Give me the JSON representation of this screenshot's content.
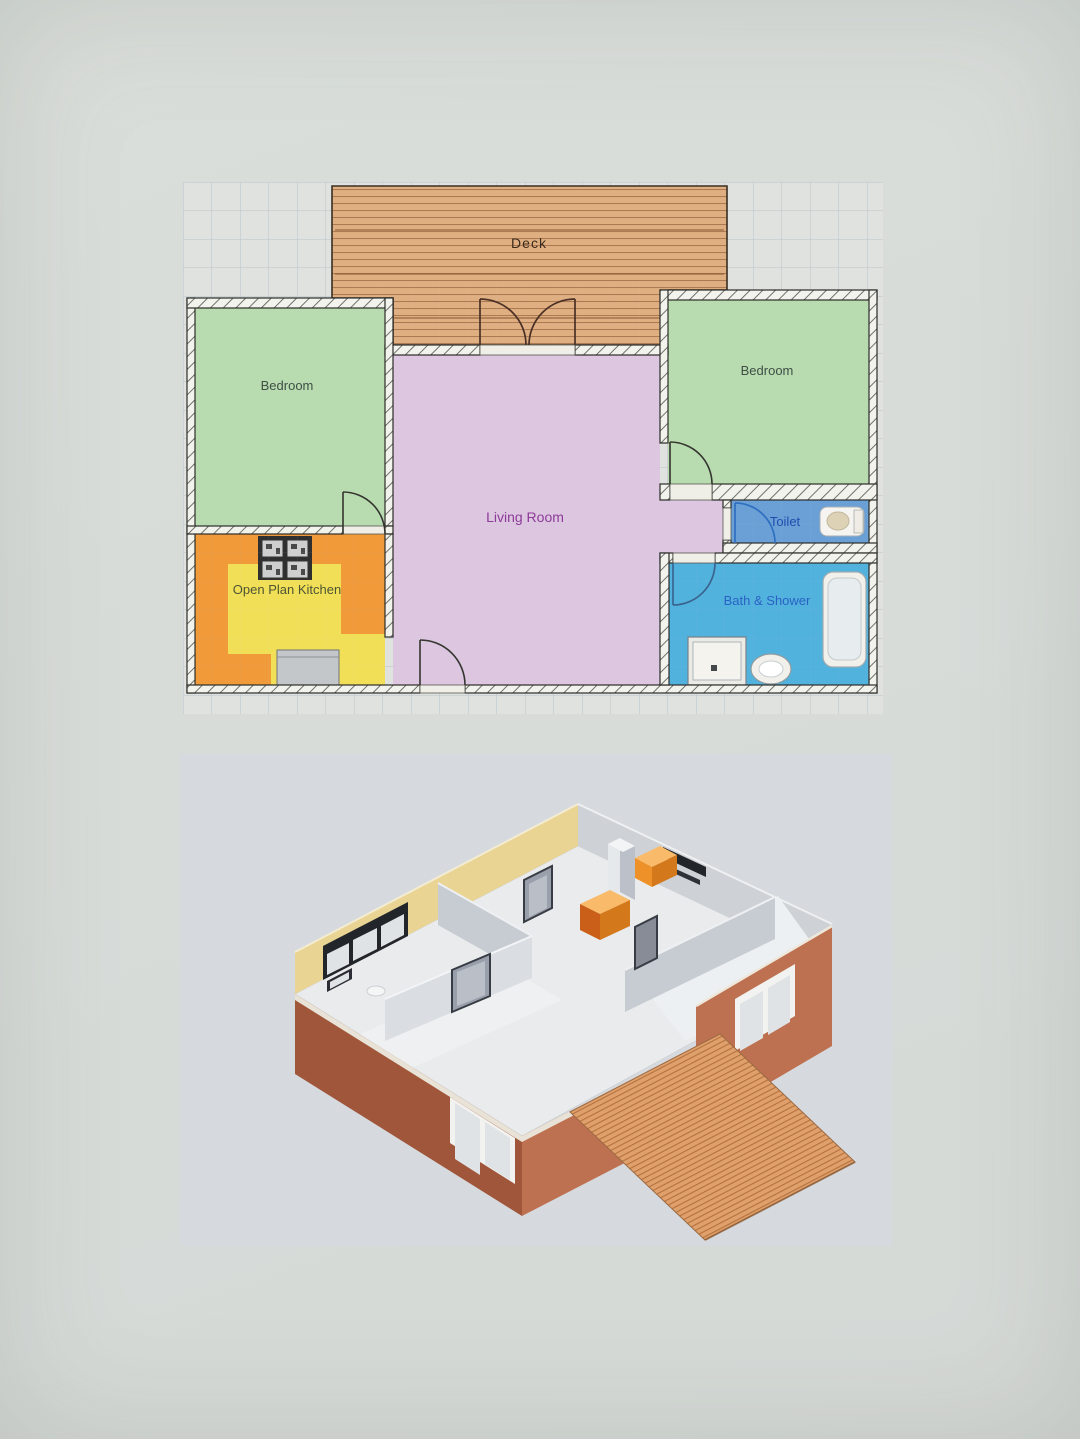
{
  "page": {
    "paper_color": "#d8dcd9"
  },
  "floor_plan": {
    "area_background": "#dfe2df",
    "grid_color": "#b4bfc4",
    "wall_fill": "#f3f3ee",
    "wall_outline": "#2c2c28",
    "rooms": {
      "deck": {
        "label": "Deck",
        "fill": "#e0af81",
        "stripe_color": "#a3714a",
        "label_color": "#3b2b1c"
      },
      "bedroom_left": {
        "label": "Bedroom",
        "fill": "#b8dcb0",
        "label_color": "#3f4f46"
      },
      "bedroom_right": {
        "label": "Bedroom",
        "fill": "#b8dcb0",
        "label_color": "#3f4f46"
      },
      "living_room": {
        "label": "Living Room",
        "fill": "#dcc6e0",
        "label_color": "#8e3b9a"
      },
      "toilet": {
        "label": "Toilet",
        "fill": "#6aa0d6",
        "label_color": "#1e4fae",
        "door_color": "#2f6fc0"
      },
      "bath_shower": {
        "label": "Bath & Shower",
        "fill": "#52b2de",
        "label_color": "#2a62c4",
        "door_color": "#3a648e"
      },
      "kitchen": {
        "label": "Open Plan Kitchen",
        "fill": "#f19a3a",
        "floor_fill": "#f1e057",
        "label_color": "#4d5433"
      }
    }
  },
  "render_3d": {
    "background": "#d6dade",
    "colors": {
      "floor": "#e9ebec",
      "back_wall_yellow": "#e9d494",
      "back_wall_gray": "#ced2d7",
      "interior_wall": "#c7ccd2",
      "interior_wall_light": "#dadee2",
      "brick_light": "#bd7150",
      "brick_dark": "#a0563a",
      "trim": "#e9e3d7",
      "deck": "#dfa06c",
      "deck_stripe": "#b5713d",
      "cabinet_top": "#f9bb69",
      "cabinet_front": "#ee9128",
      "cabinet_side": "#d3791b",
      "door": "#9aa0ab",
      "door_frame": "#383c44",
      "window_frame": "#22252a",
      "window_pane": "#dfe3e6"
    }
  }
}
